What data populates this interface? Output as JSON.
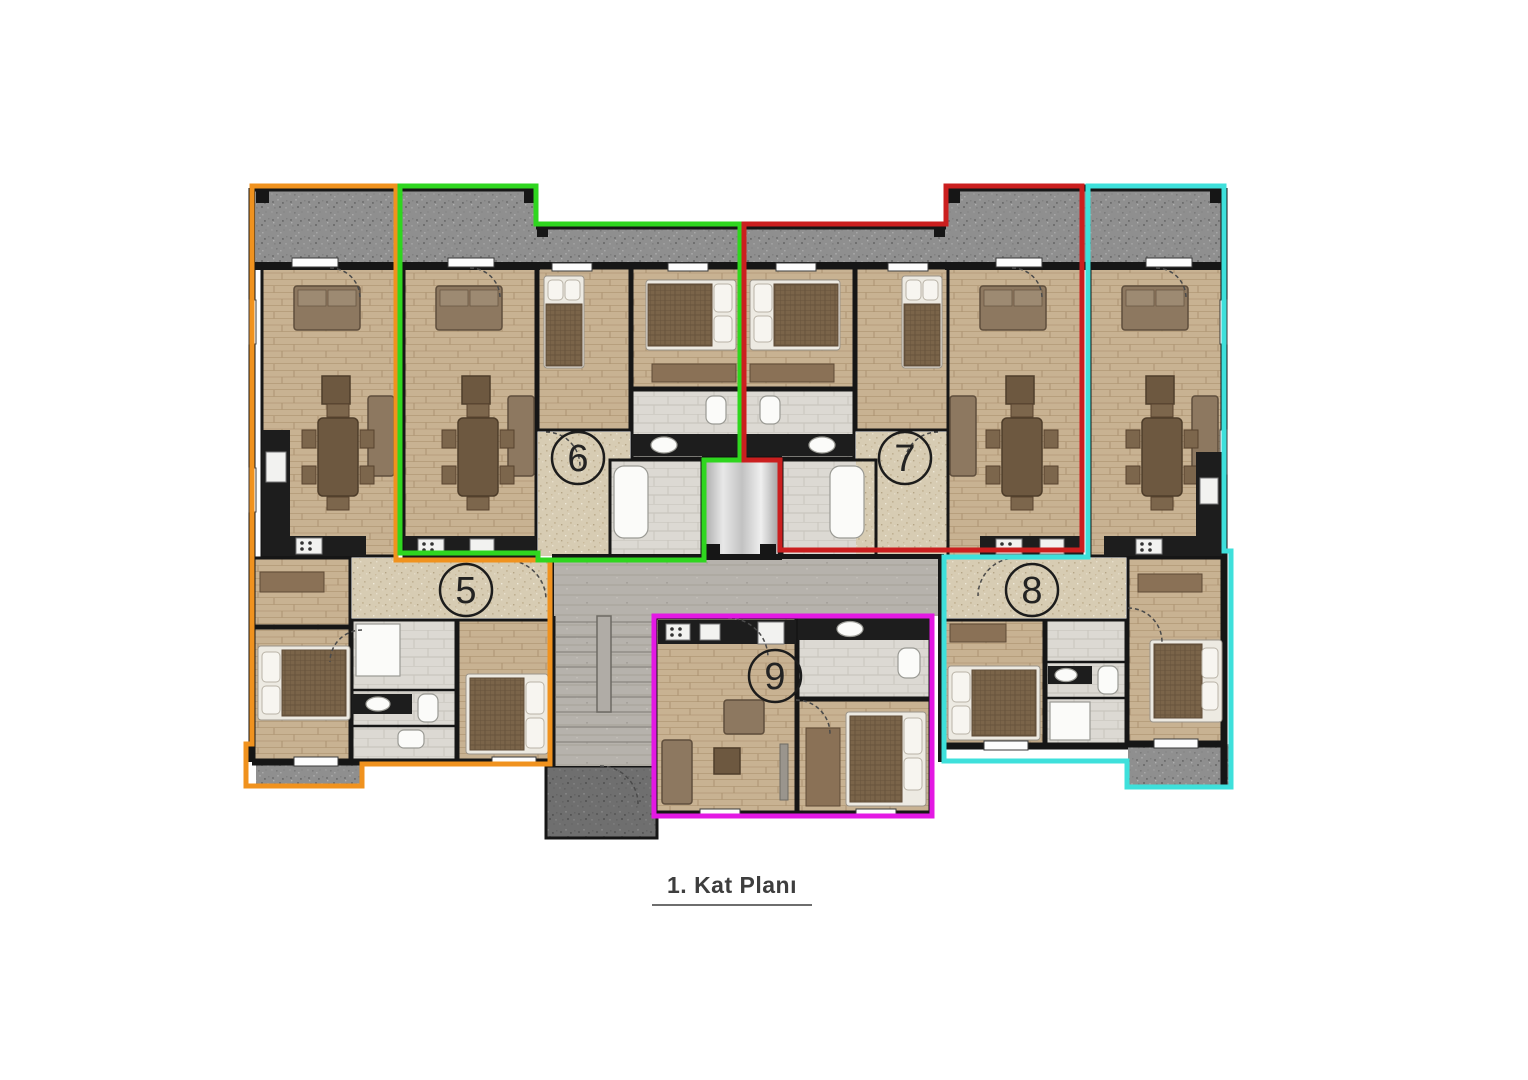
{
  "title": {
    "text": "1. Kat Planı"
  },
  "apartments": [
    {
      "number": "5",
      "outline_color": "#F0921E"
    },
    {
      "number": "6",
      "outline_color": "#2FD61F"
    },
    {
      "number": "7",
      "outline_color": "#CB1F1F"
    },
    {
      "number": "8",
      "outline_color": "#3EE0DB"
    },
    {
      "number": "9",
      "outline_color": "#E318E3"
    }
  ],
  "palette": {
    "background": "#FFFFFF",
    "walls": "#161616",
    "balcony_concrete": "#8F8F8F",
    "entrance_concrete": "#6F6F6F",
    "wood_floor": "#C8B292",
    "hall_floor": "#D7CCB3",
    "bath_tile": "#DCD9D3",
    "corridor_stone": "#B6B2AC",
    "elevator_metal": "#C9C9C9"
  }
}
